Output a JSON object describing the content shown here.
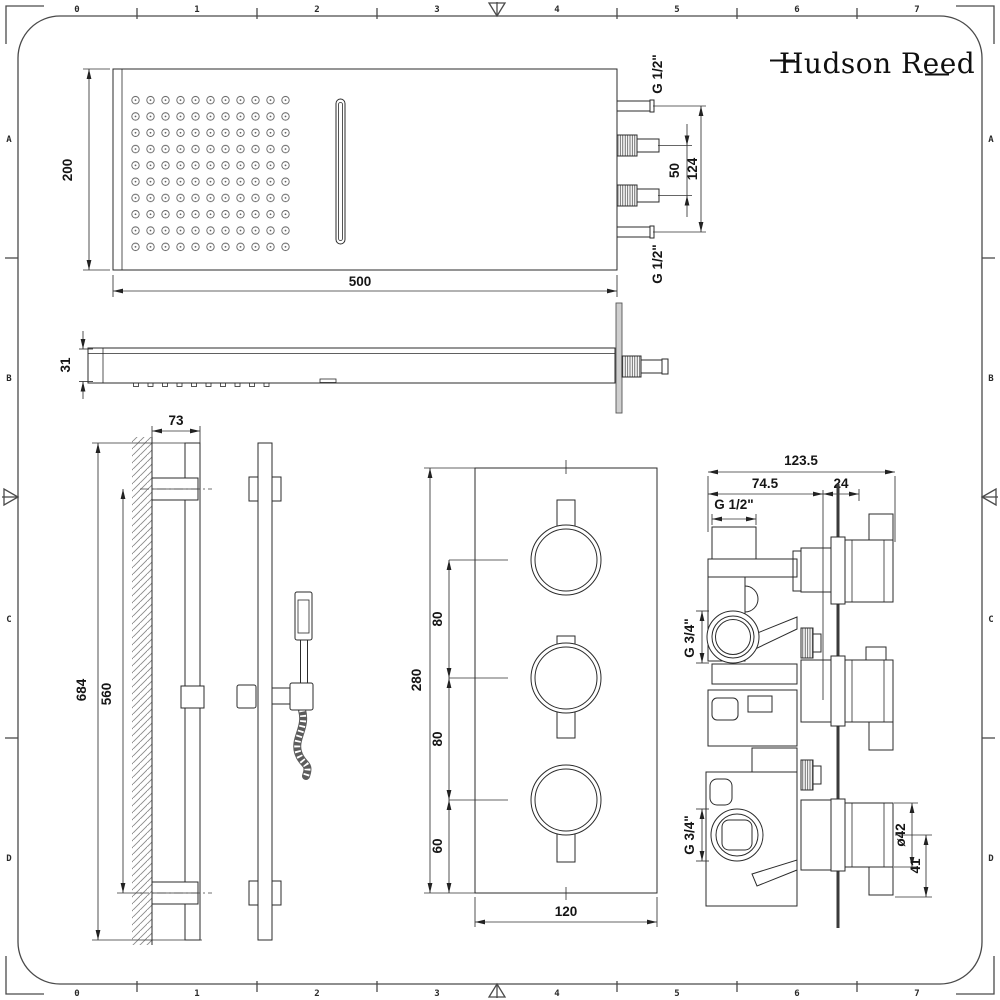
{
  "sheet": {
    "brand": "Hudson Reed",
    "colors": {
      "ink": "#2b2b2b",
      "dim_lines": "#333333",
      "wall_hatch": "#8a8a8a",
      "frame": "#4a4a4a",
      "background": "#ffffff"
    },
    "ruler": {
      "top": [
        "0",
        "1",
        "2",
        "3",
        "4",
        "5",
        "6",
        "7"
      ],
      "bottom": [
        "0",
        "1",
        "2",
        "3",
        "4",
        "5",
        "6",
        "7"
      ],
      "left": [
        "A",
        "B",
        "C",
        "D"
      ],
      "right": [
        "A",
        "B",
        "C",
        "D"
      ]
    }
  },
  "head_front": {
    "height": "200",
    "width": "500",
    "conn_top": "G 1/2\"",
    "conn_bottom": "G 1/2\"",
    "conn_pitch": "50",
    "conn_span": "124"
  },
  "head_side": {
    "thickness": "31"
  },
  "rail": {
    "wall_offset": "73",
    "overall_height": "684",
    "bracket_span": "560"
  },
  "valve_front": {
    "height": "280",
    "gap_top": "80",
    "gap_mid": "80",
    "gap_bottom": "60",
    "width": "120"
  },
  "valve_side": {
    "overall_depth": "123.5",
    "body_depth": "74.5",
    "plate_depth": "24",
    "inlet_top": "G 1/2\"",
    "port_upper": "G 3/4\"",
    "port_lower": "G 3/4\"",
    "knob_diameter": "ø42",
    "knob_depth": "41"
  }
}
